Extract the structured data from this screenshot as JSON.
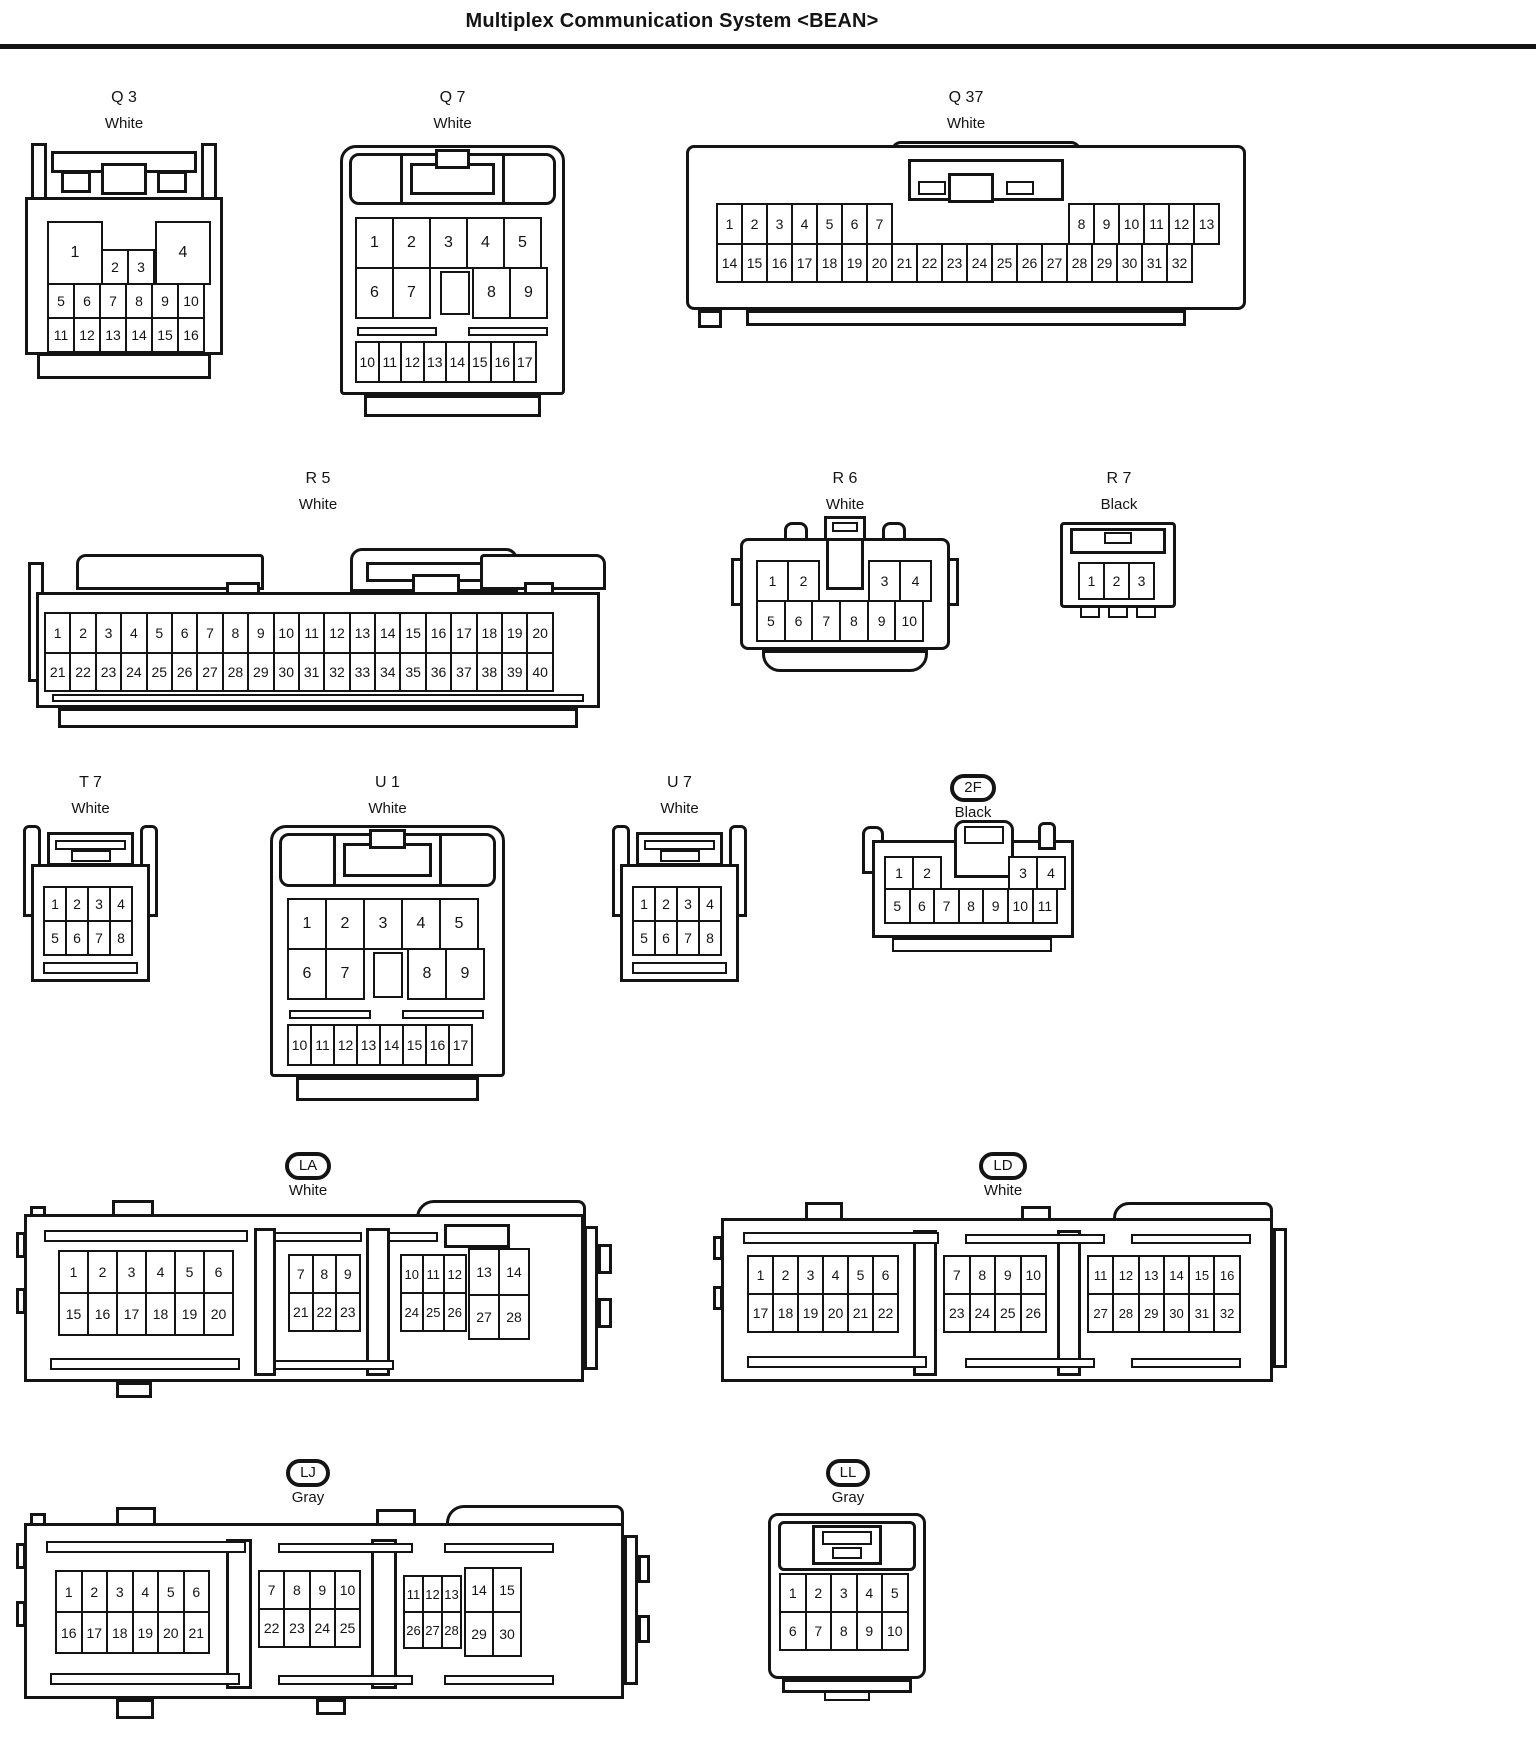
{
  "title": "Multiplex Communication System <BEAN>",
  "connectors": {
    "q3": {
      "label": "Q 3",
      "color": "White",
      "r1a": [
        "1"
      ],
      "r1b": [
        "2",
        "3"
      ],
      "r1c": [
        "4"
      ],
      "r2": [
        "5",
        "6",
        "7",
        "8",
        "9",
        "10"
      ],
      "r3": [
        "11",
        "12",
        "13",
        "14",
        "15",
        "16"
      ]
    },
    "q7": {
      "label": "Q 7",
      "color": "White",
      "r1": [
        "1",
        "2",
        "3",
        "4",
        "5"
      ],
      "r2a": [
        "6",
        "7"
      ],
      "r2b": [
        "8",
        "9"
      ],
      "r3": [
        "10",
        "11",
        "12",
        "13",
        "14",
        "15",
        "16",
        "17"
      ]
    },
    "q37": {
      "label": "Q 37",
      "color": "White",
      "r1a": [
        "1",
        "2",
        "3",
        "4",
        "5",
        "6",
        "7"
      ],
      "r1b": [
        "8",
        "9",
        "10",
        "11",
        "12",
        "13"
      ],
      "r2": [
        "14",
        "15",
        "16",
        "17",
        "18",
        "19",
        "20",
        "21",
        "22",
        "23",
        "24",
        "25",
        "26",
        "27",
        "28",
        "29",
        "30",
        "31",
        "32"
      ]
    },
    "r5": {
      "label": "R 5",
      "color": "White",
      "r1": [
        "1",
        "2",
        "3",
        "4",
        "5",
        "6",
        "7",
        "8",
        "9",
        "10",
        "11",
        "12",
        "13",
        "14",
        "15",
        "16",
        "17",
        "18",
        "19",
        "20"
      ],
      "r2": [
        "21",
        "22",
        "23",
        "24",
        "25",
        "26",
        "27",
        "28",
        "29",
        "30",
        "31",
        "32",
        "33",
        "34",
        "35",
        "36",
        "37",
        "38",
        "39",
        "40"
      ]
    },
    "r6": {
      "label": "R 6",
      "color": "White",
      "r1a": [
        "1",
        "2"
      ],
      "r1b": [
        "3",
        "4"
      ],
      "r2": [
        "5",
        "6",
        "7",
        "8",
        "9",
        "10"
      ]
    },
    "r7": {
      "label": "R 7",
      "color": "Black",
      "r1": [
        "1",
        "2",
        "3"
      ]
    },
    "t7": {
      "label": "T 7",
      "color": "White",
      "r1": [
        "1",
        "2",
        "3",
        "4"
      ],
      "r2": [
        "5",
        "6",
        "7",
        "8"
      ]
    },
    "u1": {
      "label": "U 1",
      "color": "White",
      "r1": [
        "1",
        "2",
        "3",
        "4",
        "5"
      ],
      "r2a": [
        "6",
        "7"
      ],
      "r2b": [
        "8",
        "9"
      ],
      "r3": [
        "10",
        "11",
        "12",
        "13",
        "14",
        "15",
        "16",
        "17"
      ]
    },
    "u7": {
      "label": "U 7",
      "color": "White",
      "r1": [
        "1",
        "2",
        "3",
        "4"
      ],
      "r2": [
        "5",
        "6",
        "7",
        "8"
      ]
    },
    "f2": {
      "label": "2F",
      "color": "Black",
      "r1a": [
        "1",
        "2"
      ],
      "r1b": [
        "3",
        "4"
      ],
      "r2": [
        "5",
        "6",
        "7",
        "8",
        "9",
        "10",
        "11"
      ]
    },
    "la": {
      "label": "LA",
      "color": "White",
      "g1r1": [
        "1",
        "2",
        "3",
        "4",
        "5",
        "6"
      ],
      "g1r2": [
        "15",
        "16",
        "17",
        "18",
        "19",
        "20"
      ],
      "g2r1": [
        "7",
        "8",
        "9"
      ],
      "g2r2": [
        "21",
        "22",
        "23"
      ],
      "g3r1a": [
        "10",
        "11",
        "12"
      ],
      "g3r1b": [
        "13",
        "14"
      ],
      "g3r2a": [
        "24",
        "25",
        "26"
      ],
      "g3r2b": [
        "27",
        "28"
      ]
    },
    "ld": {
      "label": "LD",
      "color": "White",
      "g1r1": [
        "1",
        "2",
        "3",
        "4",
        "5",
        "6"
      ],
      "g1r2": [
        "17",
        "18",
        "19",
        "20",
        "21",
        "22"
      ],
      "g2r1": [
        "7",
        "8",
        "9",
        "10"
      ],
      "g2r2": [
        "23",
        "24",
        "25",
        "26"
      ],
      "g3r1": [
        "11",
        "12",
        "13",
        "14",
        "15",
        "16"
      ],
      "g3r2": [
        "27",
        "28",
        "29",
        "30",
        "31",
        "32"
      ]
    },
    "lj": {
      "label": "LJ",
      "color": "Gray",
      "g1r1": [
        "1",
        "2",
        "3",
        "4",
        "5",
        "6"
      ],
      "g1r2": [
        "16",
        "17",
        "18",
        "19",
        "20",
        "21"
      ],
      "g2r1": [
        "7",
        "8",
        "9",
        "10"
      ],
      "g2r2": [
        "22",
        "23",
        "24",
        "25"
      ],
      "g3r1a": [
        "11",
        "12",
        "13"
      ],
      "g3r1b": [
        "14",
        "15"
      ],
      "g3r2a": [
        "26",
        "27",
        "28"
      ],
      "g3r2b": [
        "29",
        "30"
      ]
    },
    "ll": {
      "label": "LL",
      "color": "Gray",
      "r1": [
        "1",
        "2",
        "3",
        "4",
        "5"
      ],
      "r2": [
        "6",
        "7",
        "8",
        "9",
        "10"
      ]
    }
  }
}
